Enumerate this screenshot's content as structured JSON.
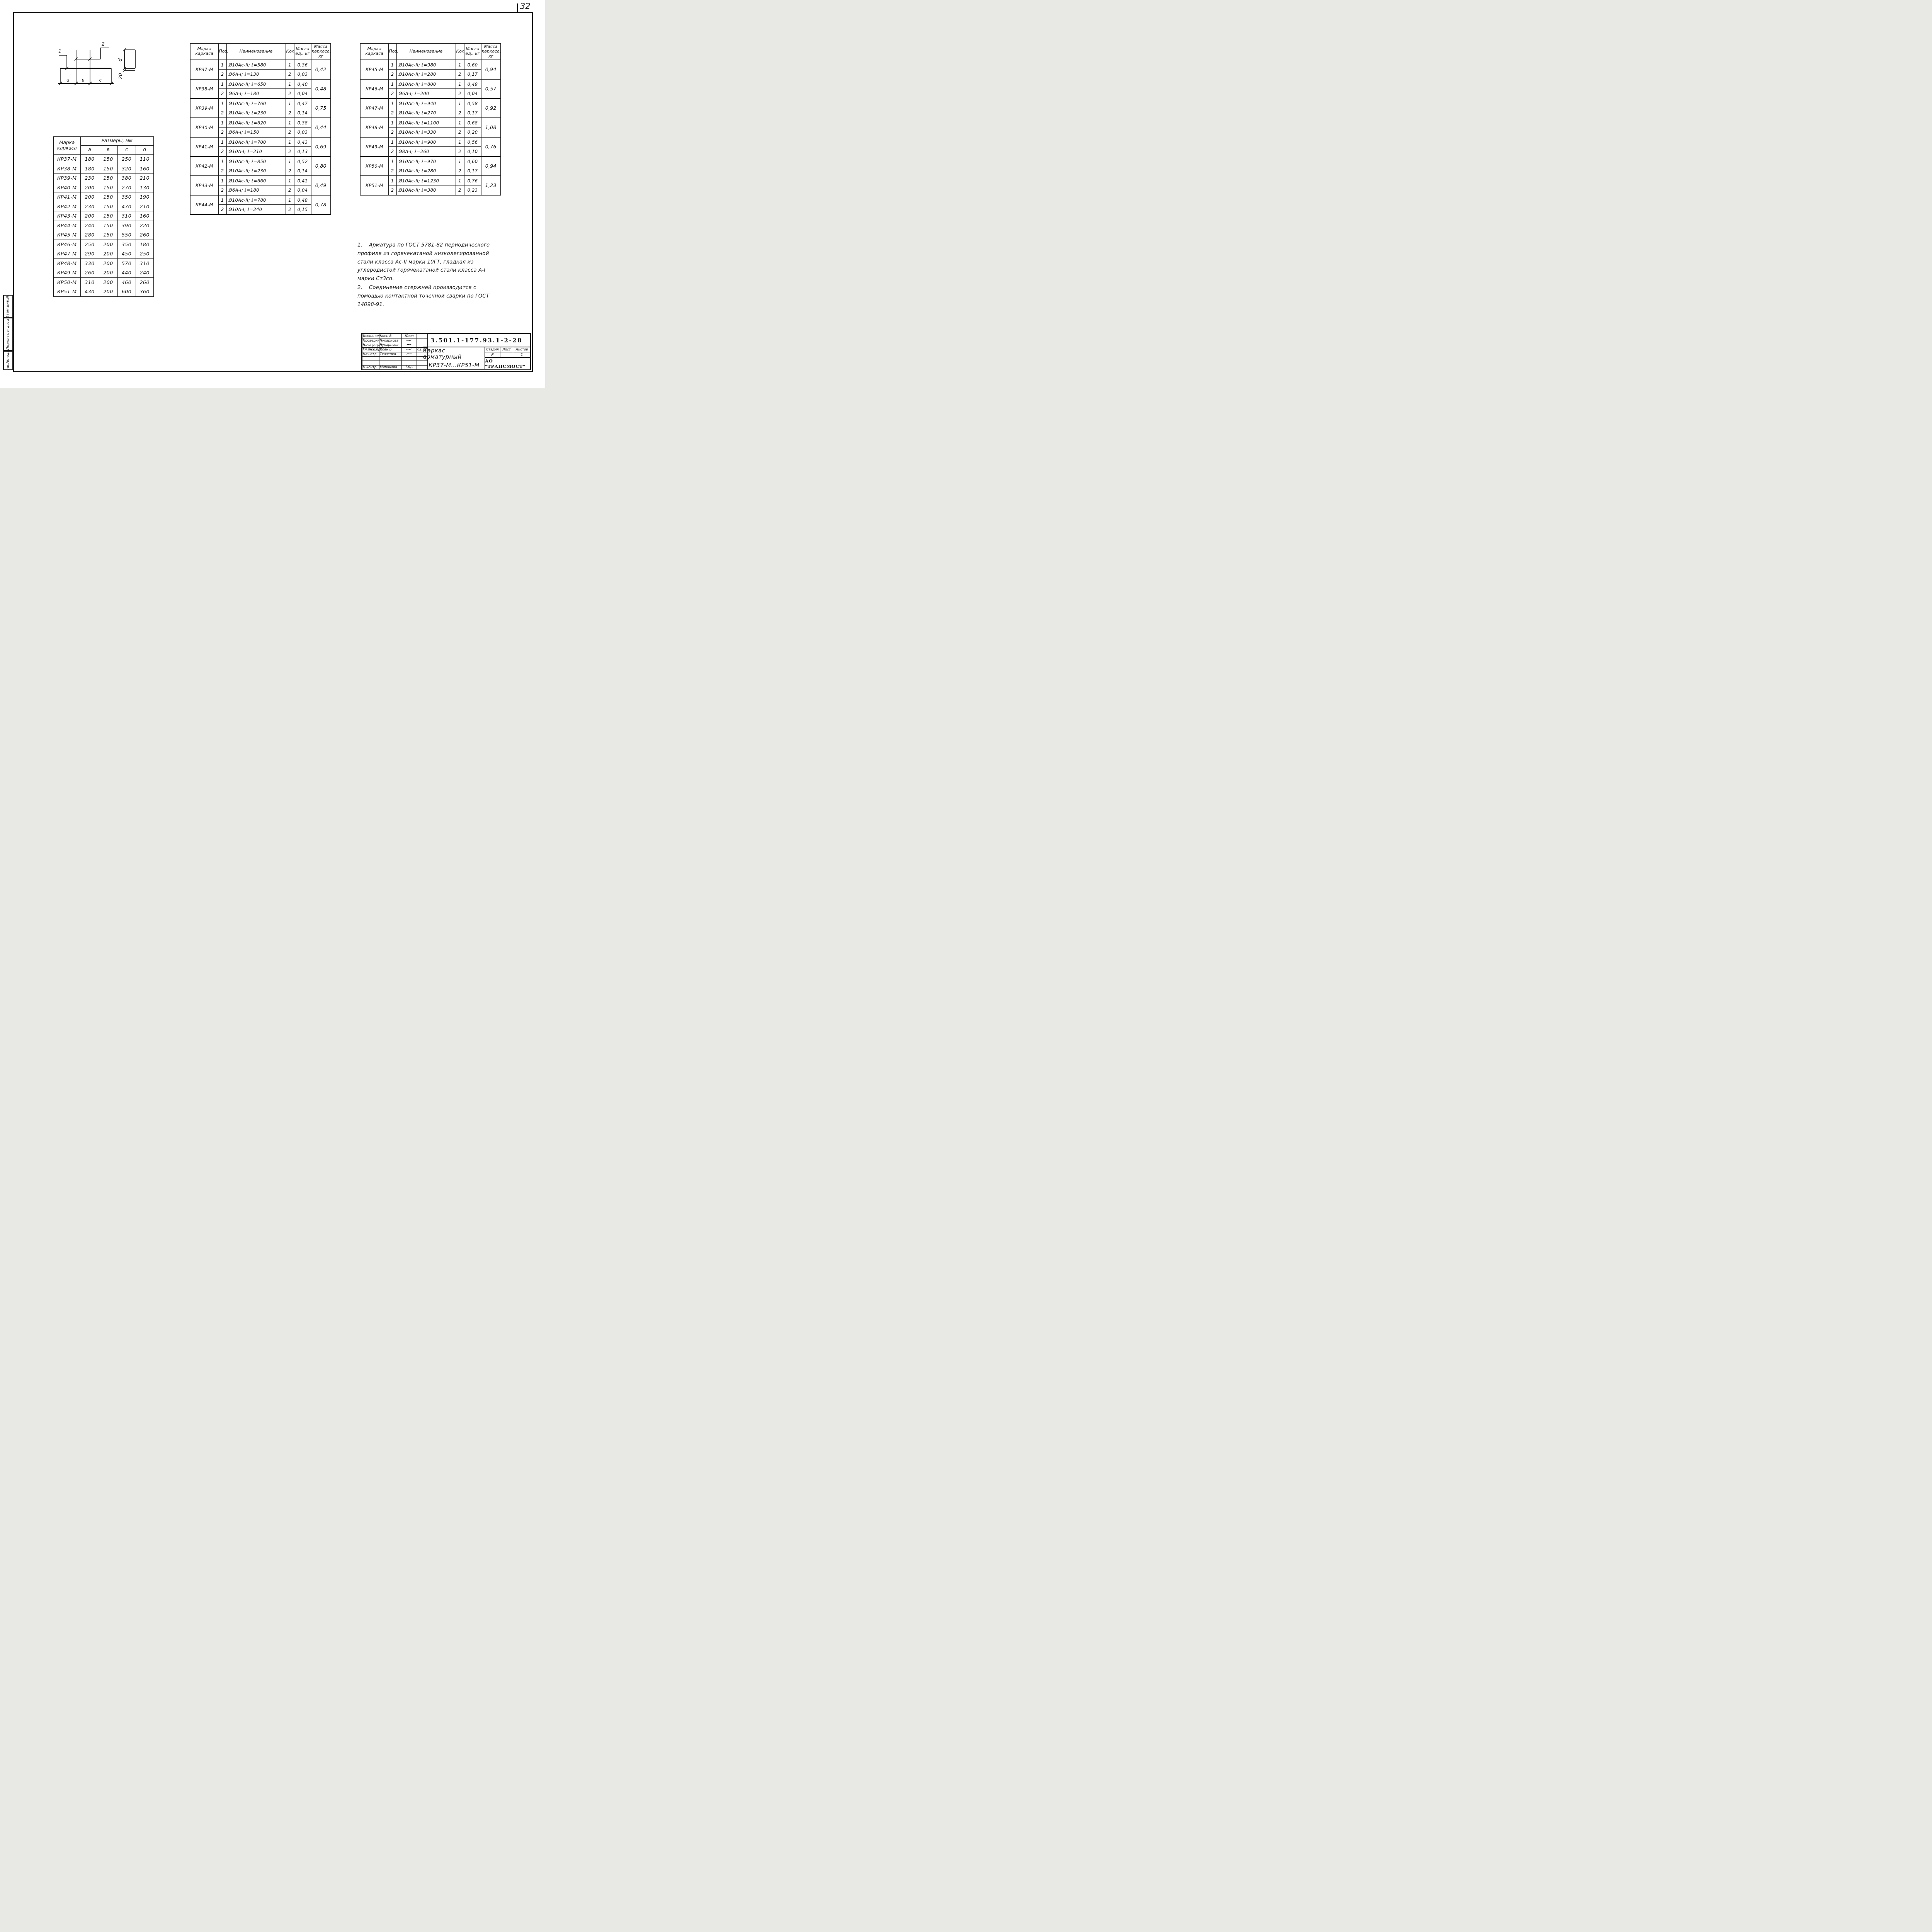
{
  "page": {
    "sheet_number": "32"
  },
  "margin_stamp": {
    "cells": [
      "Взам.инв.№",
      "Подпись и дата",
      "Инв.№подл."
    ]
  },
  "sketch": {
    "labels": {
      "pos1": "1",
      "pos2": "2",
      "a": "a",
      "b": "в",
      "c": "c",
      "d": "d",
      "hook": "20"
    }
  },
  "dimensions_table": {
    "header": {
      "mark_label": "Марка каркаса",
      "sizes_label": "Размеры, мм",
      "cols": [
        "a",
        "в",
        "c",
        "d"
      ]
    },
    "rows": [
      {
        "mark": "КР37-М",
        "a": "180",
        "b": "150",
        "c": "250",
        "d": "110"
      },
      {
        "mark": "КР38-М",
        "a": "180",
        "b": "150",
        "c": "320",
        "d": "160"
      },
      {
        "mark": "КР39-М",
        "a": "230",
        "b": "150",
        "c": "380",
        "d": "210"
      },
      {
        "mark": "КР40-М",
        "a": "200",
        "b": "150",
        "c": "270",
        "d": "130"
      },
      {
        "mark": "КР41-М",
        "a": "200",
        "b": "150",
        "c": "350",
        "d": "190"
      },
      {
        "mark": "КР42-М",
        "a": "230",
        "b": "150",
        "c": "470",
        "d": "210"
      },
      {
        "mark": "КР43-М",
        "a": "200",
        "b": "150",
        "c": "310",
        "d": "160"
      },
      {
        "mark": "КР44-М",
        "a": "240",
        "b": "150",
        "c": "390",
        "d": "220"
      },
      {
        "mark": "КР45-М",
        "a": "280",
        "b": "150",
        "c": "550",
        "d": "260"
      },
      {
        "mark": "КР46-М",
        "a": "250",
        "b": "200",
        "c": "350",
        "d": "180"
      },
      {
        "mark": "КР47-М",
        "a": "290",
        "b": "200",
        "c": "450",
        "d": "250"
      },
      {
        "mark": "КР48-М",
        "a": "330",
        "b": "200",
        "c": "570",
        "d": "310"
      },
      {
        "mark": "КР49-М",
        "a": "260",
        "b": "200",
        "c": "440",
        "d": "240"
      },
      {
        "mark": "КР50-М",
        "a": "310",
        "b": "200",
        "c": "460",
        "d": "260"
      },
      {
        "mark": "КР51-М",
        "a": "430",
        "b": "200",
        "c": "600",
        "d": "360"
      }
    ]
  },
  "spec_header": {
    "mark": "Марка каркаса",
    "pos": "Поз.",
    "name": "Наименование",
    "qty": "Кол.",
    "unit_mass": "Масса ед., кг",
    "frame_mass": "Масса каркаса, кг"
  },
  "spec_tables": [
    {
      "groups": [
        {
          "mark": "КР37-М",
          "frame_mass": "0,42",
          "items": [
            {
              "pos": "1",
              "name": "Ø10Ас-II; ℓ=580",
              "qty": "1",
              "mass": "0,36"
            },
            {
              "pos": "2",
              "name": "Ø6А-I; ℓ=130",
              "qty": "2",
              "mass": "0,03"
            }
          ]
        },
        {
          "mark": "КР38-М",
          "frame_mass": "0,48",
          "items": [
            {
              "pos": "1",
              "name": "Ø10Ас-II; ℓ=650",
              "qty": "1",
              "mass": "0,40"
            },
            {
              "pos": "2",
              "name": "Ø6А-I; ℓ=180",
              "qty": "2",
              "mass": "0,04"
            }
          ]
        },
        {
          "mark": "КР39-М",
          "frame_mass": "0,75",
          "items": [
            {
              "pos": "1",
              "name": "Ø10Ас-II; ℓ=760",
              "qty": "1",
              "mass": "0,47"
            },
            {
              "pos": "2",
              "name": "Ø10Ас-II; ℓ=230",
              "qty": "2",
              "mass": "0,14"
            }
          ]
        },
        {
          "mark": "КР40-М",
          "frame_mass": "0,44",
          "items": [
            {
              "pos": "1",
              "name": "Ø10Ас-II; ℓ=620",
              "qty": "1",
              "mass": "0,38"
            },
            {
              "pos": "2",
              "name": "Ø6А-I; ℓ=150",
              "qty": "2",
              "mass": "0,03"
            }
          ]
        },
        {
          "mark": "КР41-М",
          "frame_mass": "0,69",
          "items": [
            {
              "pos": "1",
              "name": "Ø10Ас-II; ℓ=700",
              "qty": "1",
              "mass": "0,43"
            },
            {
              "pos": "2",
              "name": "Ø10А-I; ℓ=210",
              "qty": "2",
              "mass": "0,13"
            }
          ]
        },
        {
          "mark": "КР42-М",
          "frame_mass": "0,80",
          "items": [
            {
              "pos": "1",
              "name": "Ø10Ас-II; ℓ=850",
              "qty": "1",
              "mass": "0,52"
            },
            {
              "pos": "2",
              "name": "Ø10Ас-II; ℓ=230",
              "qty": "2",
              "mass": "0,14"
            }
          ]
        },
        {
          "mark": "КР43-М",
          "frame_mass": "0,49",
          "items": [
            {
              "pos": "1",
              "name": "Ø10Ас-II; ℓ=660",
              "qty": "1",
              "mass": "0,41"
            },
            {
              "pos": "2",
              "name": "Ø6А-I; ℓ=180",
              "qty": "2",
              "mass": "0,04"
            }
          ]
        },
        {
          "mark": "КР44-М",
          "frame_mass": "0,78",
          "items": [
            {
              "pos": "1",
              "name": "Ø10Ас-II; ℓ=780",
              "qty": "1",
              "mass": "0,48"
            },
            {
              "pos": "2",
              "name": "Ø10А-I; ℓ=240",
              "qty": "2",
              "mass": "0,15"
            }
          ]
        }
      ]
    },
    {
      "groups": [
        {
          "mark": "КР45-М",
          "frame_mass": "0,94",
          "items": [
            {
              "pos": "1",
              "name": "Ø10Ас-II; ℓ=980",
              "qty": "1",
              "mass": "0,60"
            },
            {
              "pos": "2",
              "name": "Ø10Ас-II; ℓ=280",
              "qty": "2",
              "mass": "0,17"
            }
          ]
        },
        {
          "mark": "КР46-М",
          "frame_mass": "0,57",
          "items": [
            {
              "pos": "1",
              "name": "Ø10Ас-II; ℓ=800",
              "qty": "1",
              "mass": "0,49"
            },
            {
              "pos": "2",
              "name": "Ø6А-I; ℓ=200",
              "qty": "2",
              "mass": "0,04"
            }
          ]
        },
        {
          "mark": "КР47-М",
          "frame_mass": "0,92",
          "items": [
            {
              "pos": "1",
              "name": "Ø10Ас-II; ℓ=940",
              "qty": "1",
              "mass": "0,58"
            },
            {
              "pos": "2",
              "name": "Ø10Ас-II; ℓ=270",
              "qty": "2",
              "mass": "0,17"
            }
          ]
        },
        {
          "mark": "КР48-М",
          "frame_mass": "1,08",
          "items": [
            {
              "pos": "1",
              "name": "Ø10Ас-II; ℓ=1100",
              "qty": "1",
              "mass": "0,68"
            },
            {
              "pos": "2",
              "name": "Ø10Ас-II; ℓ=330",
              "qty": "2",
              "mass": "0,20"
            }
          ]
        },
        {
          "mark": "КР49-М",
          "frame_mass": "0,76",
          "items": [
            {
              "pos": "1",
              "name": "Ø10Ас-II; ℓ=900",
              "qty": "1",
              "mass": "0,56"
            },
            {
              "pos": "2",
              "name": "Ø8А-I; ℓ=260",
              "qty": "2",
              "mass": "0,10"
            }
          ]
        },
        {
          "mark": "КР50-М",
          "frame_mass": "0,94",
          "items": [
            {
              "pos": "1",
              "name": "Ø10Ас-II; ℓ=970",
              "qty": "1",
              "mass": "0,60"
            },
            {
              "pos": "2",
              "name": "Ø10Ас-II; ℓ=280",
              "qty": "2",
              "mass": "0,17"
            }
          ]
        },
        {
          "mark": "КР51-М",
          "frame_mass": "1,23",
          "items": [
            {
              "pos": "1",
              "name": "Ø10Ас-II; ℓ=1230",
              "qty": "1",
              "mass": "0,76"
            },
            {
              "pos": "2",
              "name": "Ø10Ас-II; ℓ=380",
              "qty": "2",
              "mass": "0,23"
            }
          ]
        }
      ]
    }
  ],
  "notes": [
    {
      "num": "1.",
      "text": "Арматура по ГОСТ 5781-82 периодического профиля из горячекатаной низколегированной стали класса Ас-II марки 10ГТ, гладкая из углеродистой горячекатаной стали класса А-I марки Ст3сп."
    },
    {
      "num": "2.",
      "text": "Соединение стержней производится с помощью контактной точечной сварки по ГОСТ 14098-91."
    }
  ],
  "title_block": {
    "doc_number": "3.501.1-177.93.1-2-28",
    "title_line1": "Каркас арматурный",
    "title_line2": "КР37-М...КР51-М",
    "company": "АО \"ТРАНСМОСТ\"",
    "stage_header": [
      "Стадия",
      "Лист",
      "Листов"
    ],
    "stage_values": [
      "Р",
      "",
      "1"
    ],
    "sign_rows": [
      {
        "role": "Исполнил",
        "name": "Коен В.",
        "sign": "Коен",
        "date": ""
      },
      {
        "role": "Проверил",
        "name": "Чупарнова",
        "sign": "~",
        "date": ""
      },
      {
        "role": "Нач.пр.гр.",
        "name": "Чупарнова",
        "sign": "~",
        "date": ""
      },
      {
        "role": "Гл.инж.пр.",
        "name": "Коен Б.",
        "sign": "~",
        "date": "02.94"
      },
      {
        "role": "Нач.отд.",
        "name": "Ткаченко",
        "sign": "~",
        "date": ""
      },
      {
        "role": "",
        "name": "",
        "sign": "",
        "date": ""
      },
      {
        "role": "",
        "name": "",
        "sign": "",
        "date": ""
      },
      {
        "role": "Н.контр.",
        "name": "Миронова",
        "sign": "Мц-",
        "date": ""
      }
    ]
  }
}
